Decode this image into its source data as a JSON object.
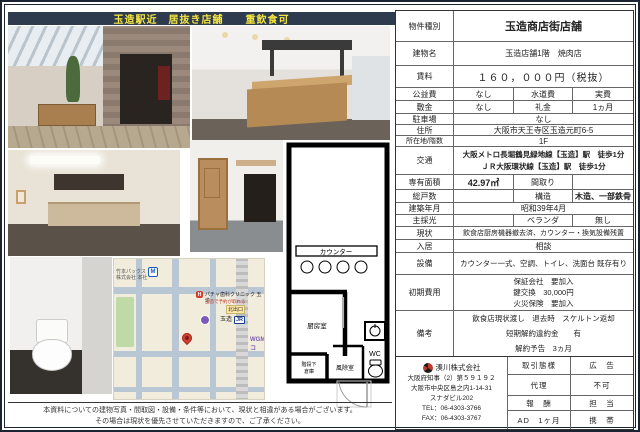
{
  "header": {
    "title": "玉造駅近　居抜き店舗　　重飲食可"
  },
  "table": {
    "type_l": "物件種別",
    "type_v": "玉造商店街店舗",
    "building_l": "建物名",
    "building_v": "玉造店舗1階　焼肉店",
    "rent_l": "賃料",
    "rent_v": "１６０，０００円（税抜）",
    "kyoeki_l": "公益費",
    "kyoeki_v": "なし",
    "suido_l": "水道費",
    "suido_v": "実費",
    "shikikin_l": "敷金",
    "shikikin_v": "なし",
    "reikin_l": "礼金",
    "reikin_v": "1ヵ月",
    "parking_l": "駐車場",
    "parking_v": "なし",
    "address_l": "住所",
    "address_v": "大阪市天王寺区玉造元町6-5",
    "floor_l": "所在地/階数",
    "floor_v": "1F",
    "access_l": "交通",
    "access_1": "大阪メトロ長堀鶴見緑地線【玉造】駅　徒歩1分",
    "access_2": "ＪＲ大阪環状線【玉造】駅　徒歩1分",
    "area_l": "専有面積",
    "area_v": "42.97㎡",
    "madori_l": "間取り",
    "madori_v": "",
    "units_l": "総戸数",
    "units_v": "",
    "structure_l": "構造",
    "structure_v": "木造、一部鉄骨",
    "built_l": "建築年月",
    "built_v": "昭和39年4月",
    "light_l": "主採光",
    "light_v": "",
    "veranda_l": "ベランダ",
    "veranda_v": "無し",
    "current_l": "現状",
    "current_v": "飲食店厨房機器撤去済、カウンター・換気設備残置",
    "movein_l": "入居",
    "movein_v": "相談",
    "equip_l": "設備",
    "equip_v": "カウンター一式、空調、トイレ、洗面台 既存有り",
    "initial_l": "初期費用",
    "initial_1": "保証会社　要加入",
    "initial_2": "鍵交換　30,000円",
    "initial_3": "火災保険　要加入",
    "notes_l": "備考",
    "notes_1": "飲食店現状渡し　退去時　スケルトン返却",
    "notes_2": "短期解約違約金　　有",
    "notes_3": "解約予告　3ヵ月"
  },
  "company": {
    "name": "湊川株式会社",
    "license": "大阪府知事（2）第５９１９２",
    "address1": "大阪市中央区島之内1-14-31",
    "address2": "スナダビル202",
    "tel": "TEL：06‑4303‑3766",
    "fax": "FAX：06‑4303‑3767",
    "torihiki_l": "取引態様",
    "torihiki_v": "代理",
    "koukoku_l": "広　告",
    "koukoku_v": "不可",
    "houshuu_l": "報　酬",
    "houshuu_v": "AD　1ヶ月",
    "tantou_l": "担　当",
    "tantou_v": "携　帯"
  },
  "floor_plan": {
    "counter": "カウンター",
    "kitchen": "厨房室",
    "under_stairs_1": "階段下",
    "under_stairs_2": "倉庫",
    "windbreak": "風除室",
    "wc": "WC"
  },
  "map": {
    "company_label": "竹本パックス株式会社 本社",
    "exit_label": "北出口",
    "station_label": "玉造",
    "jr_label": "JR",
    "metro_label": "M",
    "clinic_label": "パチャ歯科クリニック 玉造",
    "clinic_sub": "玉造で予約が取れる",
    "shop_label": "WGMコ"
  },
  "disclaimer": {
    "line1": "本資料についての建物写真・間取図・設備・条件等において、現状と相違がある場合がございます。",
    "line2": "その場合は現状を優先させていただきますので、ご了承ください。"
  }
}
